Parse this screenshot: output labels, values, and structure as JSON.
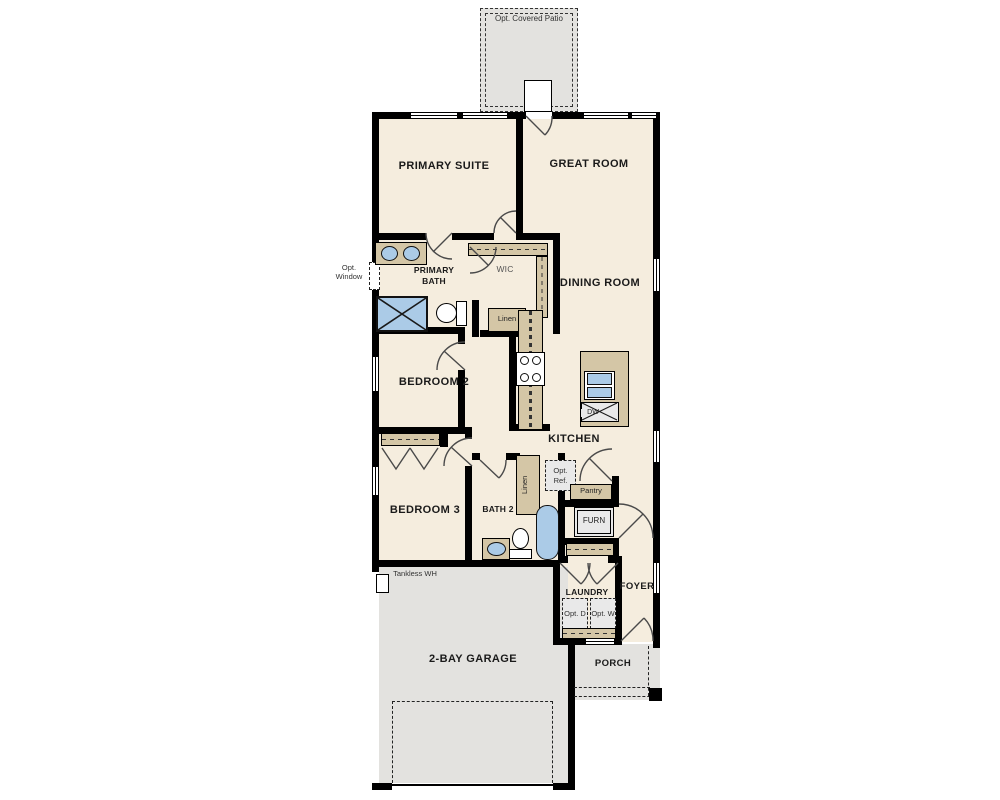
{
  "colors": {
    "floor": "#f5edde",
    "outdoor": "#e3e2df",
    "wall": "#000000",
    "cabinet": "#d4c6a6",
    "fixture": "#abcbe7",
    "optional": "#e9e9e9",
    "arc": "#4a4a4a"
  },
  "rooms": {
    "patio": "Opt. Covered Patio",
    "primary_suite": "PRIMARY SUITE",
    "great_room": "GREAT ROOM",
    "primary_bath": "PRIMARY BATH",
    "wic": "WIC",
    "dining_room": "DINING ROOM",
    "bedroom_2": "BEDROOM 2",
    "kitchen": "KITCHEN",
    "bedroom_3": "BEDROOM 3",
    "bath_2": "BATH 2",
    "laundry": "LAUNDRY",
    "foyer": "FOYER",
    "garage": "2-BAY GARAGE",
    "porch": "PORCH"
  },
  "fixtures": {
    "linen_wic": "Linen",
    "linen_hall": "Linen",
    "pantry": "Pantry",
    "furnace": "FURN",
    "dishwasher": "DW",
    "opt_ref": "Opt. Ref.",
    "opt_dryer": "Opt. D",
    "opt_washer": "Opt. W",
    "opt_window": "Opt. Window",
    "tankless": "Tankless WH"
  }
}
